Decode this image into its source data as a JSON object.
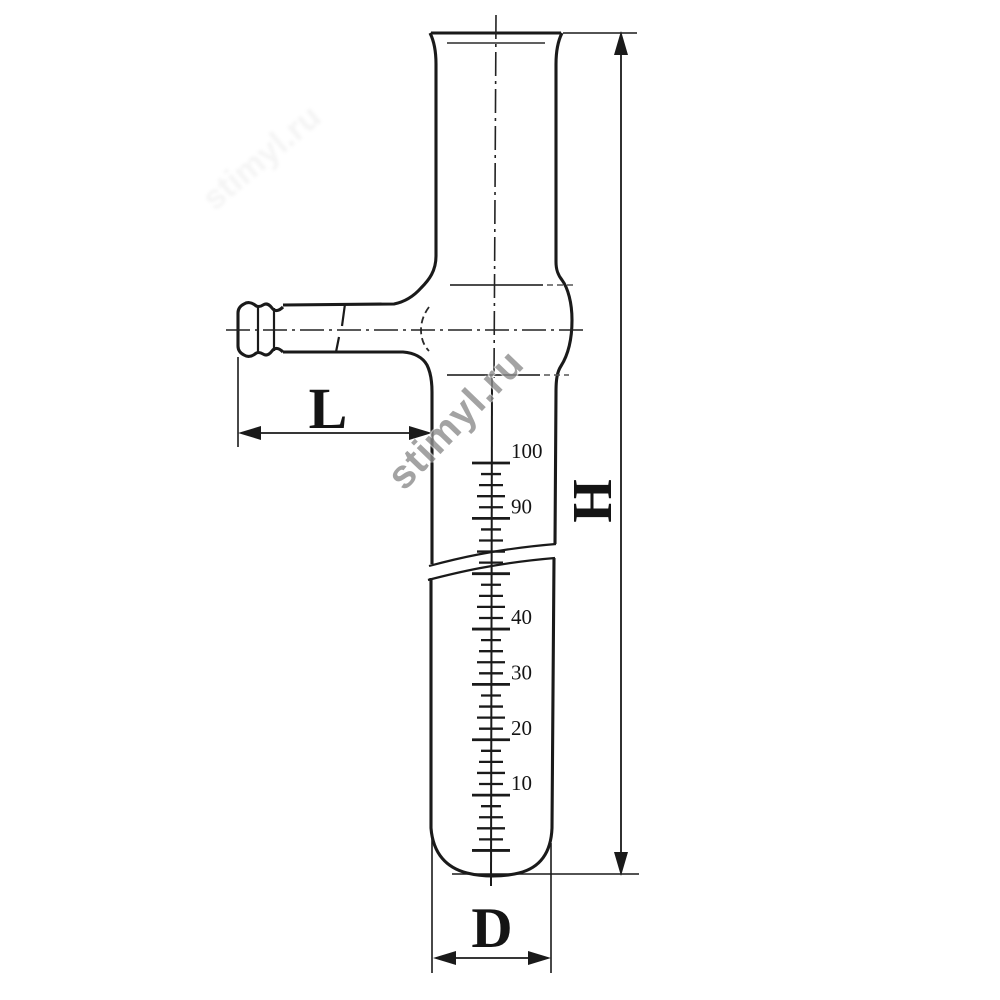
{
  "watermark": {
    "text": "stimyl.ru",
    "color": "#8d8d8d"
  },
  "dimensions": {
    "length_label": "L",
    "height_label": "H",
    "diameter_label": "D"
  },
  "scale": {
    "ticks_total": 36,
    "major_every": 5,
    "major_labels": [
      {
        "index": 0,
        "text": "100"
      },
      {
        "index": 5,
        "text": "90"
      },
      {
        "index": 15,
        "text": "40"
      },
      {
        "index": 20,
        "text": "30"
      },
      {
        "index": 25,
        "text": "20"
      },
      {
        "index": 30,
        "text": "10"
      }
    ]
  },
  "colors": {
    "line": "#1a1a1a",
    "background": "#ffffff",
    "watermark": "#8d8d8d"
  }
}
